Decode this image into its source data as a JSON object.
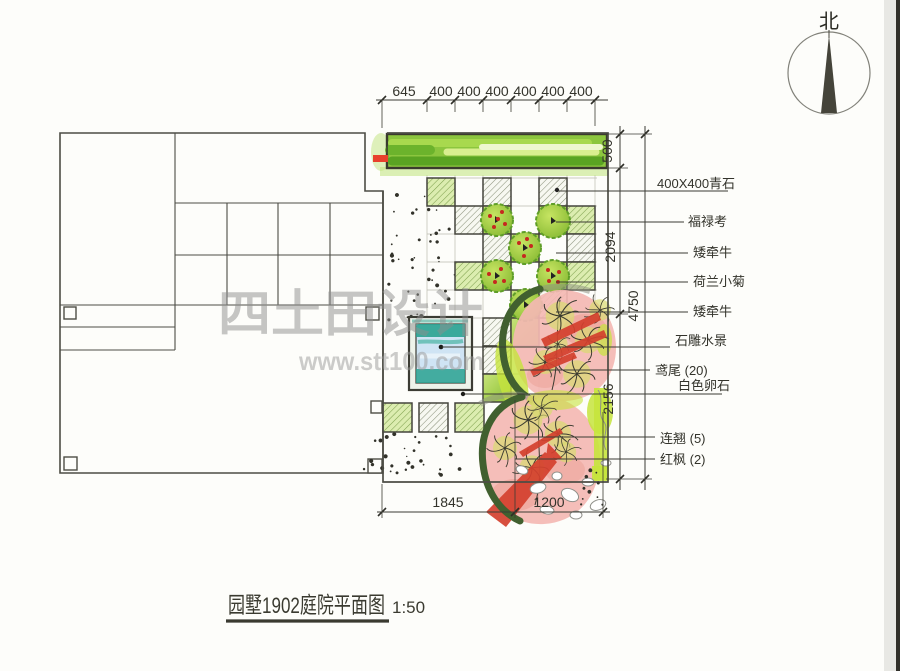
{
  "compass": {
    "label": "北"
  },
  "watermark": {
    "line1": "四土田设计",
    "line2": "www.stt100.com"
  },
  "title": {
    "text": "园墅1902庭院平面图",
    "scale": "1:50"
  },
  "dims": {
    "top": [
      "645",
      "400",
      "400",
      "400",
      "400",
      "400",
      "400"
    ],
    "right_inner": [
      "500",
      "2094",
      "2156"
    ],
    "right_outer": [
      "4750"
    ],
    "bottom": [
      "1845",
      "1200"
    ]
  },
  "labels": [
    "400X400青石",
    "福禄考",
    "矮牵牛",
    "荷兰小菊",
    "矮牵牛",
    "石雕水景",
    "鸢尾 (20)",
    "白色卵石",
    "连翘 (5)",
    "红枫 (2)"
  ],
  "colors": {
    "line": "#3c3c34",
    "hedge_green": "#8cc63e",
    "plant_green": "#a9d254",
    "water_teal": "#2aa291",
    "canopy_pink": "#f4b9b3",
    "maple_red": "#d4402e",
    "forsythia": "#c6e43c",
    "hedge_arc_green": "#41602f",
    "watermark_gray": "#8e8e8e"
  }
}
